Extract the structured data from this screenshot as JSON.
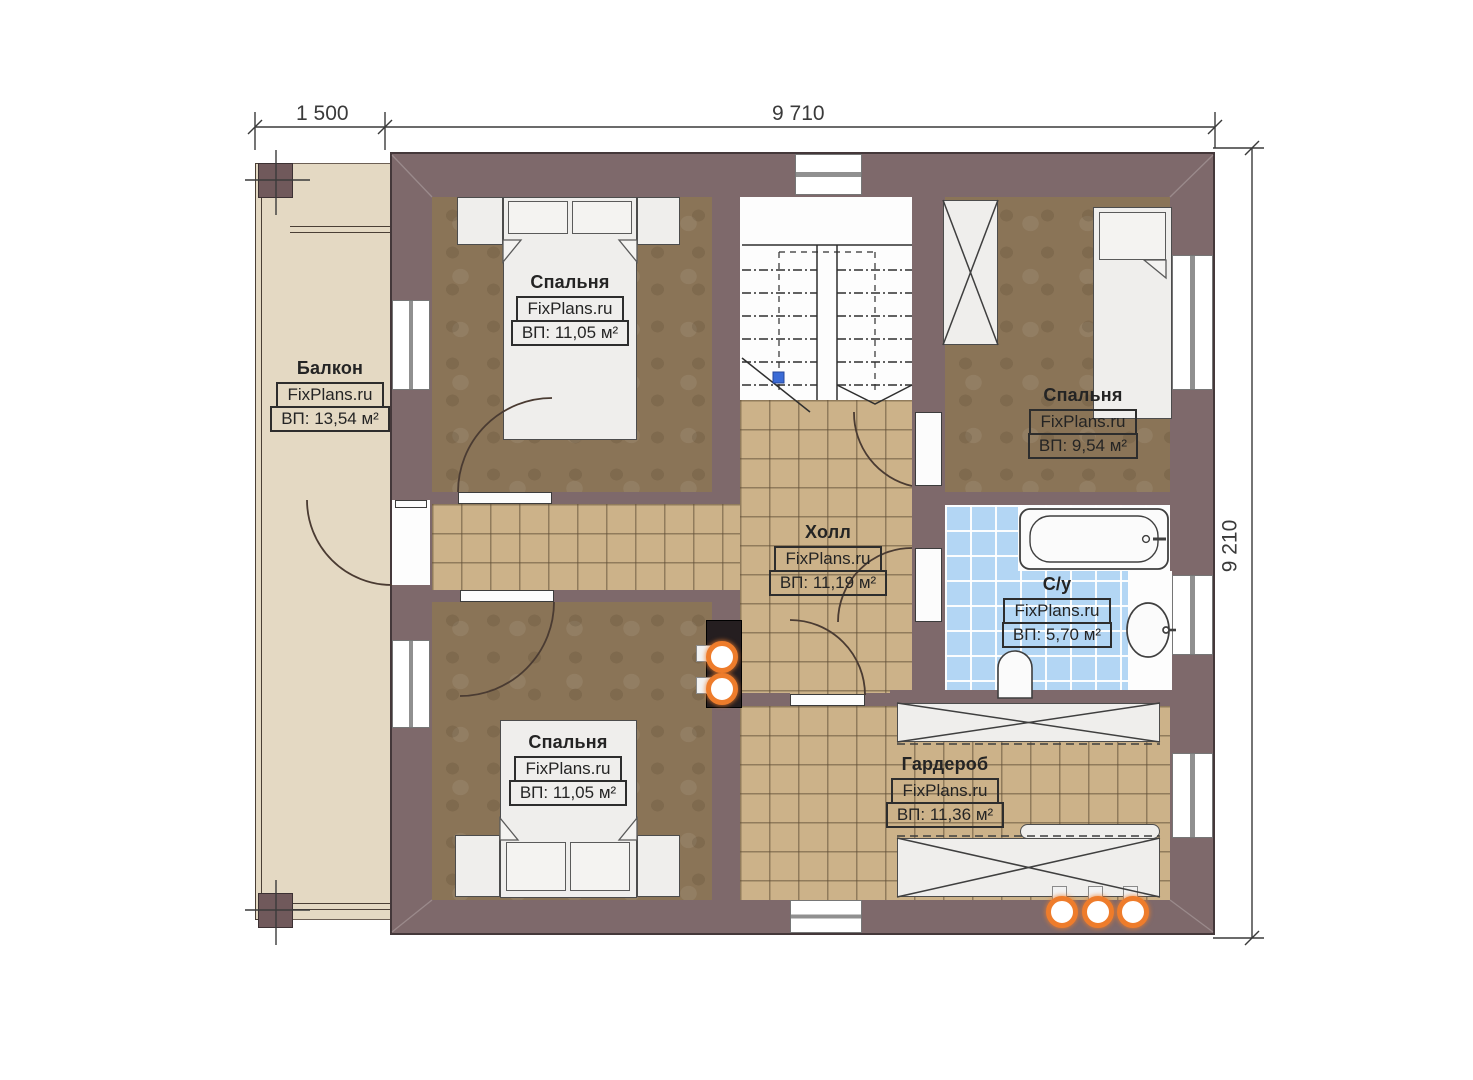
{
  "plan_title": "Second floor plan (FixPlans.ru)",
  "brand": "FixPlans.ru",
  "dimensions": {
    "balcony_width_mm": "1 500",
    "house_width_mm": "9 710",
    "house_height_mm": "9 210"
  },
  "rooms": {
    "balcony": {
      "name": "Балкон",
      "watermark": "FixPlans.ru",
      "area": "ВП: 13,54 м²"
    },
    "bedroom_tl": {
      "name": "Спальня",
      "watermark": "FixPlans.ru",
      "area": "ВП: 11,05 м²"
    },
    "bedroom_tr": {
      "name": "Спальня",
      "watermark": "FixPlans.ru",
      "area": "ВП: 9,54 м²"
    },
    "hall": {
      "name": "Холл",
      "watermark": "FixPlans.ru",
      "area": "ВП: 11,19 м²"
    },
    "bathroom": {
      "name": "С/у",
      "watermark": "FixPlans.ru",
      "area": "ВП: 5,70 м²"
    },
    "wardrobe": {
      "name": "Гардероб",
      "watermark": "FixPlans.ru",
      "area": "ВП: 11,36 м²"
    },
    "bedroom_bl": {
      "name": "Спальня",
      "watermark": "FixPlans.ru",
      "area": "ВП: 11,05 м²"
    }
  },
  "colors": {
    "wall": "#7e696b",
    "wall_outline": "#44383a",
    "carpet": "#8a7457",
    "corridor_tile": "#ccb289",
    "bathroom_tile": "#b3d6f4",
    "balcony_floor": "#e4d9c3",
    "light_accent_orange": "#ee7c2b",
    "background": "#ffffff"
  }
}
